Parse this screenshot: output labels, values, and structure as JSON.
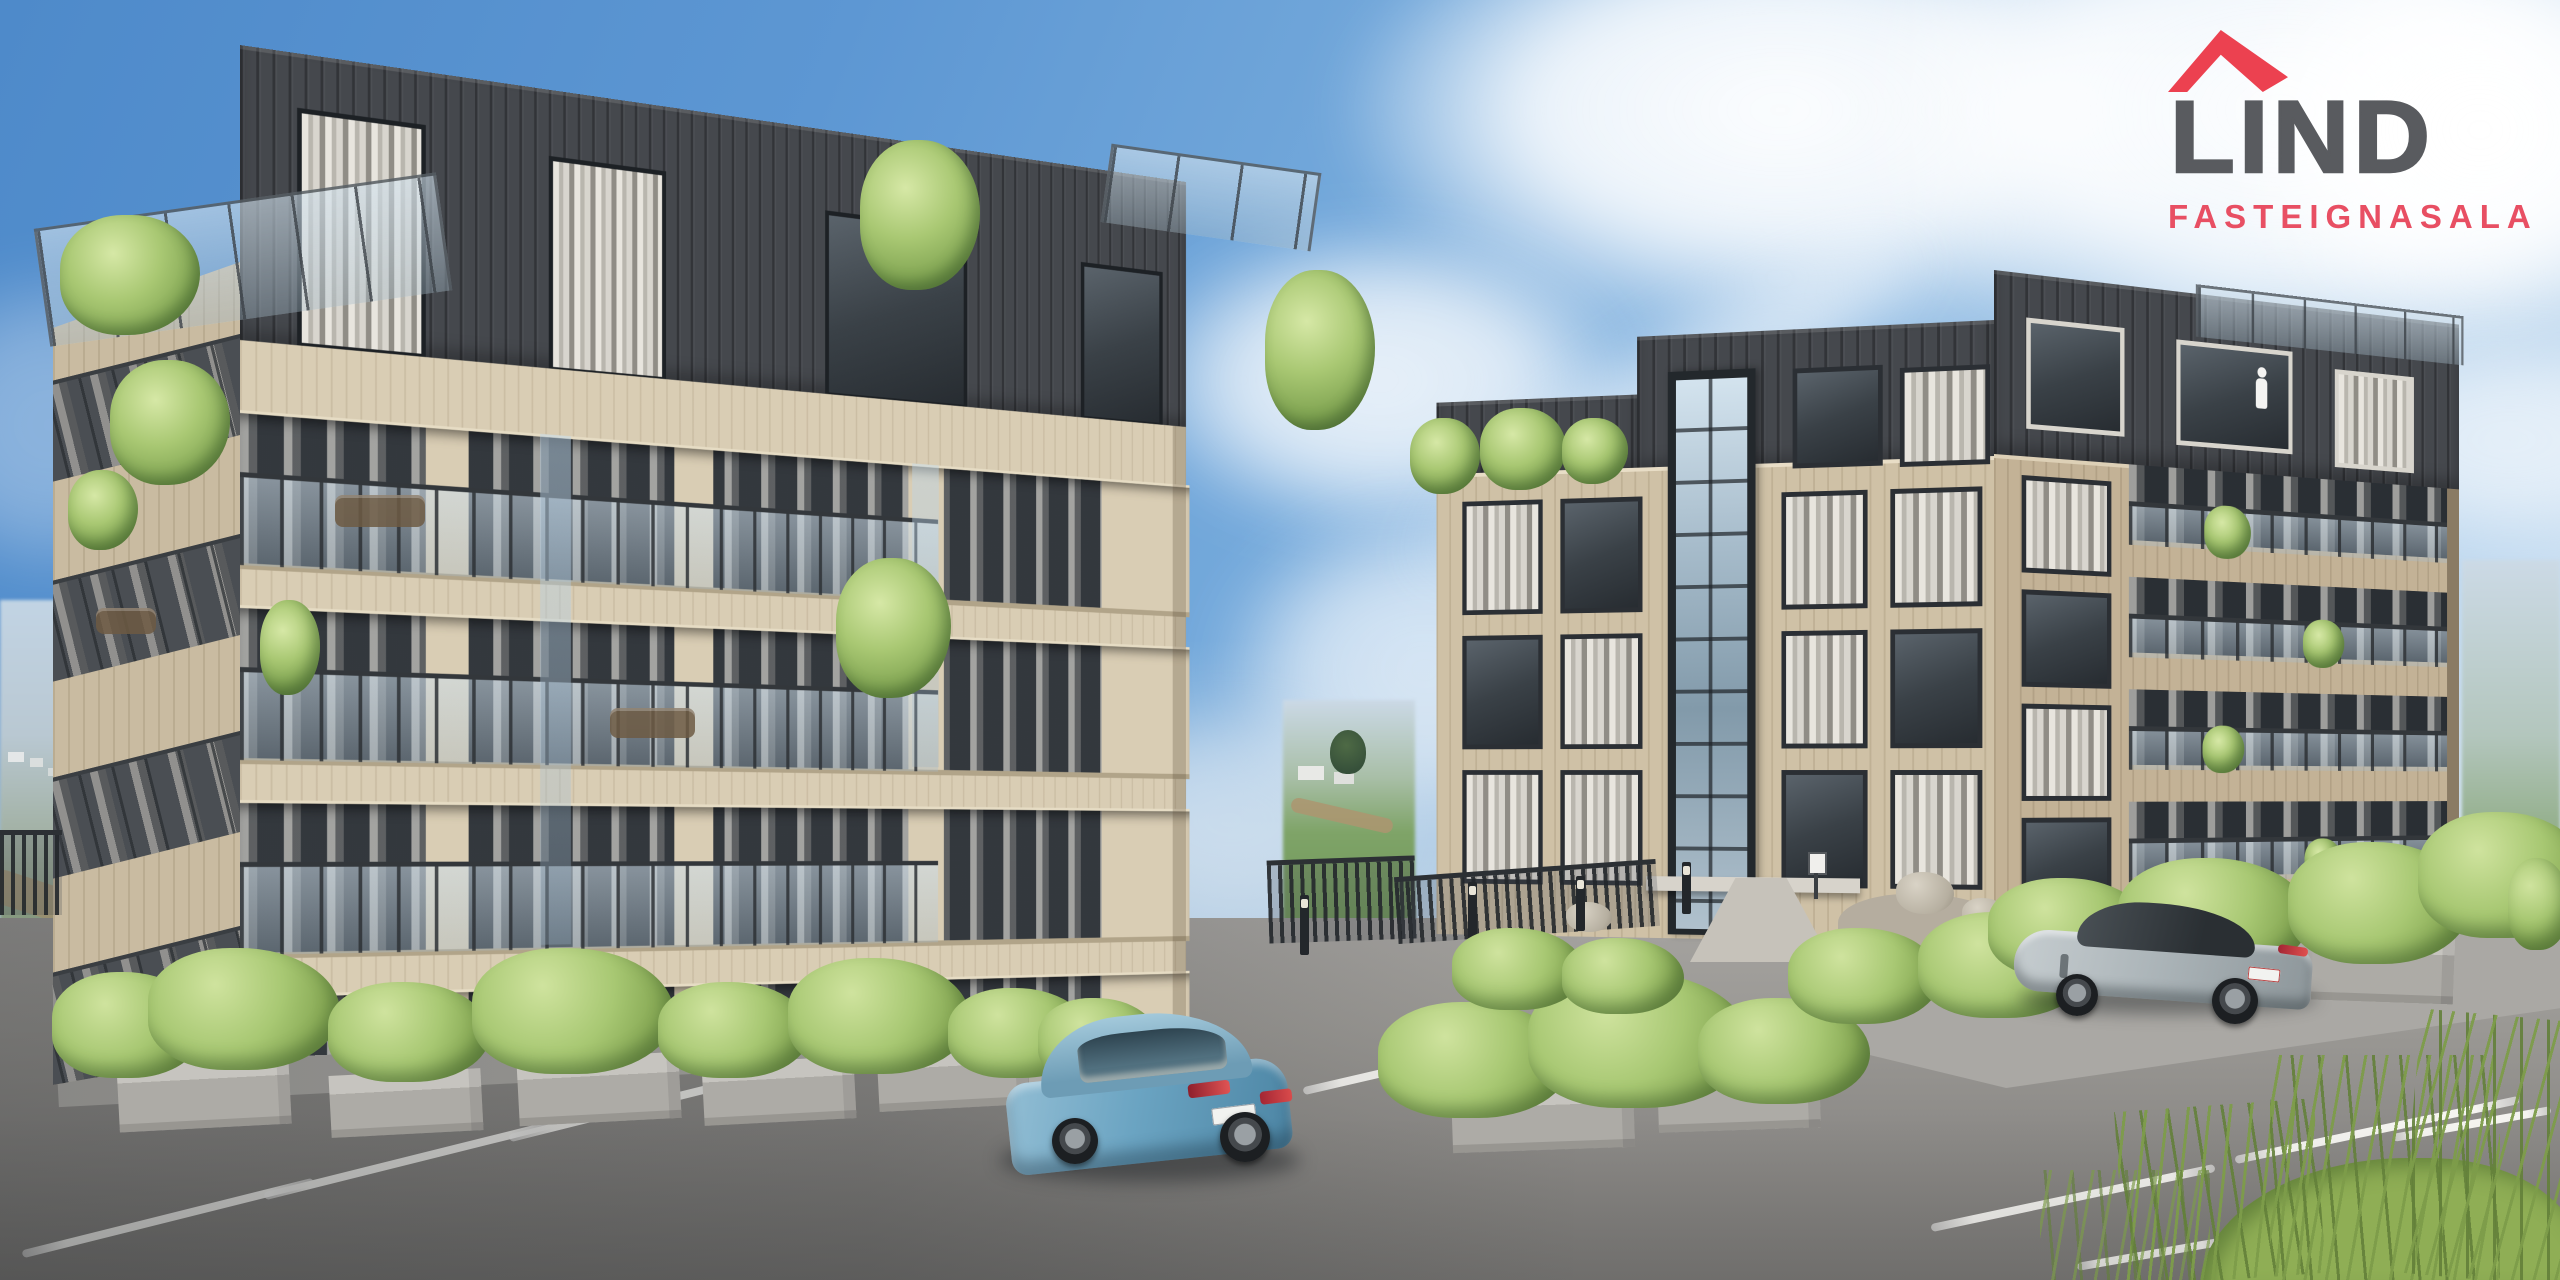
{
  "brand": {
    "name": "LIND",
    "tagline": "FASTEIGNASALA",
    "logo": {
      "roof_icon_color": "#ec4150",
      "name_color": "#595b5f",
      "tagline_color": "#e84f63"
    }
  },
  "palette": {
    "sky_top": "#4e8aca",
    "sky_horizon": "#cfe2f3",
    "cloud": "#ffffff",
    "facade_beige": "#d9cdb4",
    "facade_beige_shaded": "#c9bba1",
    "facade_tan_right_building": "#c3b296",
    "dark_cladding": "#45484d",
    "window_frame": "#2b2f34",
    "balcony_glass": "#cfe0ec",
    "asphalt": "#96948f",
    "parking_line": "#f5f4f0",
    "sidewalk": "#b7b5b0",
    "foliage": "#a9c873",
    "car_blue": "#6ba4c2",
    "car_gray": "#aeb6ba",
    "taillight_red": "#c62f38"
  }
}
